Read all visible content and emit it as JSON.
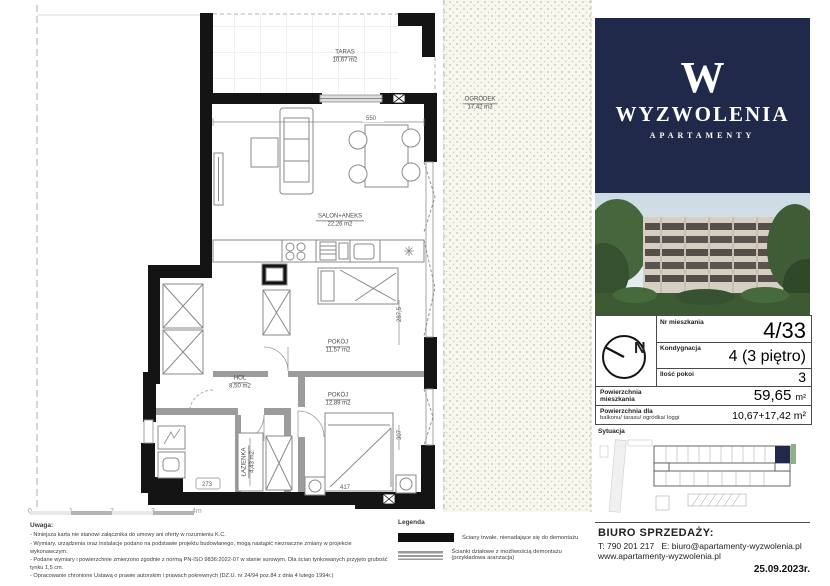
{
  "plan": {
    "rooms": [
      {
        "name": "TARAS",
        "area": "10,67 m2"
      },
      {
        "name": "SALON+ANEKS",
        "area": "22,26 m2"
      },
      {
        "name": "POKÓJ",
        "area": "11,57 m2"
      },
      {
        "name": "HOL",
        "area": "8,50 m2"
      },
      {
        "name": "ŁAZIENKA",
        "area": "4,43 m2"
      },
      {
        "name": "POKÓJ",
        "area": "12,89 m2"
      },
      {
        "name": "OGRÓDEK",
        "area": "17,42 m2"
      }
    ],
    "dimensions": {
      "living_width": "550",
      "room_depth": "287,5",
      "bed_depth": "307",
      "bath_width": "273",
      "bed_width": "417"
    },
    "scale_labels": [
      "0",
      "1",
      "2",
      "3",
      "4m"
    ]
  },
  "notes": {
    "title": "Uwaga:",
    "items": [
      "- Niniejsza karta nie stanowi załącznika do umowy ani oferty w rozumieniu K.C.",
      "- Wymiary, urządzenia oraz instalacje podano na podstawie projektu budowlanego, mogą nastąpić  nieznaczne zmiany w projekcie wykonawczym.",
      "- Podane wymiary i powierzchnie zmierzono zgodnie z normą PN-ISO 9836:2022-07 w stanie surowym. Dla ścian tynkowanych przyjęto grubość tynku 1,5 cm.",
      "- Opracowanie chronione Ustawą o prawie autorskim i prawach pokrewnych (DZ.U. nr 24/94 poz.84 z dnia 4 lutego 1994r.)"
    ]
  },
  "legend": {
    "title": "Legenda",
    "solid_label": "Ściany trwałe, nienadające się do demontażu",
    "striped_label": "Ścianki działowe z możliwością demontażu (przykładowa aranżacja)"
  },
  "sidebar": {
    "brand": {
      "monogram": "W",
      "name": "WYZWOLENIA",
      "sub": "APARTAMENTY"
    },
    "info": {
      "nr_label": "Nr mieszkania",
      "nr_value": "4/33",
      "floor_label": "Kondygnacja",
      "floor_value": "4 (3 piętro)",
      "rooms_label": "Ilość pokoi",
      "rooms_value": "3",
      "area_label": "Powierzchnia mieszkania",
      "area_value": "59,65",
      "area_unit": "m²",
      "balcony_label": "Powierzchnia dla",
      "balcony_sublabel": "balkonu/ tarasu/ ogródka/ loggi",
      "balcony_value": "10,67+17,42 m²",
      "compass_letter": "N"
    },
    "situation_label": "Sytuacja",
    "office": {
      "title": "BIURO SPRZEDAŻY:",
      "phone": "T: 790 201 217",
      "email": "E: biuro@apartamenty-wyzwolenia.pl",
      "website": "www.apartamenty-wyzwolenia.pl"
    },
    "date": "25.09.2023r."
  },
  "colors": {
    "navy": "#20294a",
    "wall": "#141414",
    "partition": "#9c9c9c",
    "garden_dot": "#c5c2ae"
  }
}
